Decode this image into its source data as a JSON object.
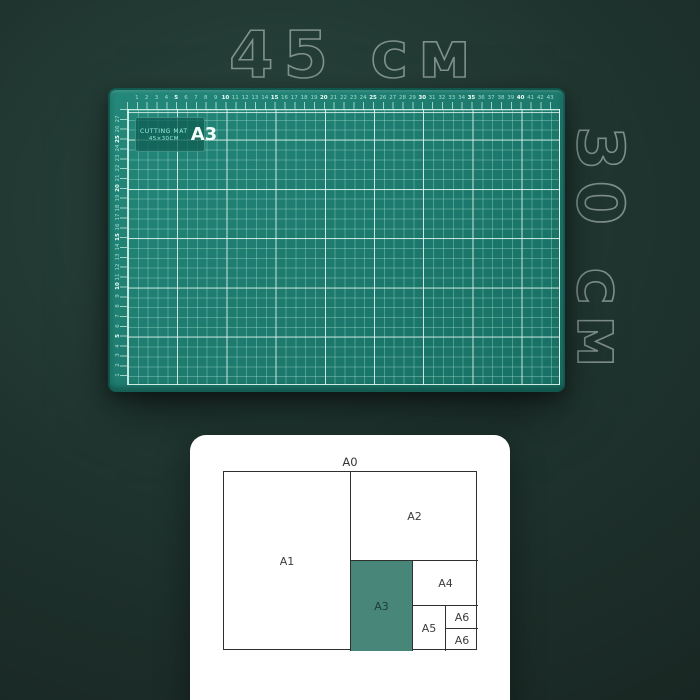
{
  "dimensions": {
    "width_label": "45 см",
    "height_label": "30 см"
  },
  "mat": {
    "badge": {
      "title": "CUTTING MAT",
      "size_text": "45×30CM",
      "format": "A3"
    },
    "top_ruler_numbers": [
      1,
      2,
      3,
      4,
      5,
      6,
      7,
      8,
      9,
      10,
      11,
      12,
      13,
      14,
      15,
      16,
      17,
      18,
      19,
      20,
      21,
      22,
      23,
      24,
      25,
      26,
      27,
      28,
      29,
      30,
      31,
      32,
      33,
      34,
      35,
      36,
      37,
      38,
      39,
      40,
      41,
      42,
      43
    ],
    "left_ruler_numbers": [
      1,
      2,
      3,
      4,
      5,
      6,
      7,
      8,
      9,
      10,
      11,
      12,
      13,
      14,
      15,
      16,
      17,
      18,
      19,
      20,
      21,
      22,
      23,
      24,
      25,
      26,
      27
    ],
    "colors": {
      "surface": "#1e7c6f",
      "grid_minor": "#a5e2d3",
      "grid_major": "#ecfcf7",
      "badge_text": "#93efdd"
    }
  },
  "size_chart": {
    "outer_label": "A0",
    "highlight_color": "#478678",
    "cells": [
      {
        "label": "A1",
        "highlighted": false
      },
      {
        "label": "A2",
        "highlighted": false
      },
      {
        "label": "A3",
        "highlighted": true
      },
      {
        "label": "A4",
        "highlighted": false
      },
      {
        "label": "A5",
        "highlighted": false
      },
      {
        "label": "A6",
        "highlighted": false
      },
      {
        "label": "A6",
        "highlighted": false
      }
    ]
  }
}
